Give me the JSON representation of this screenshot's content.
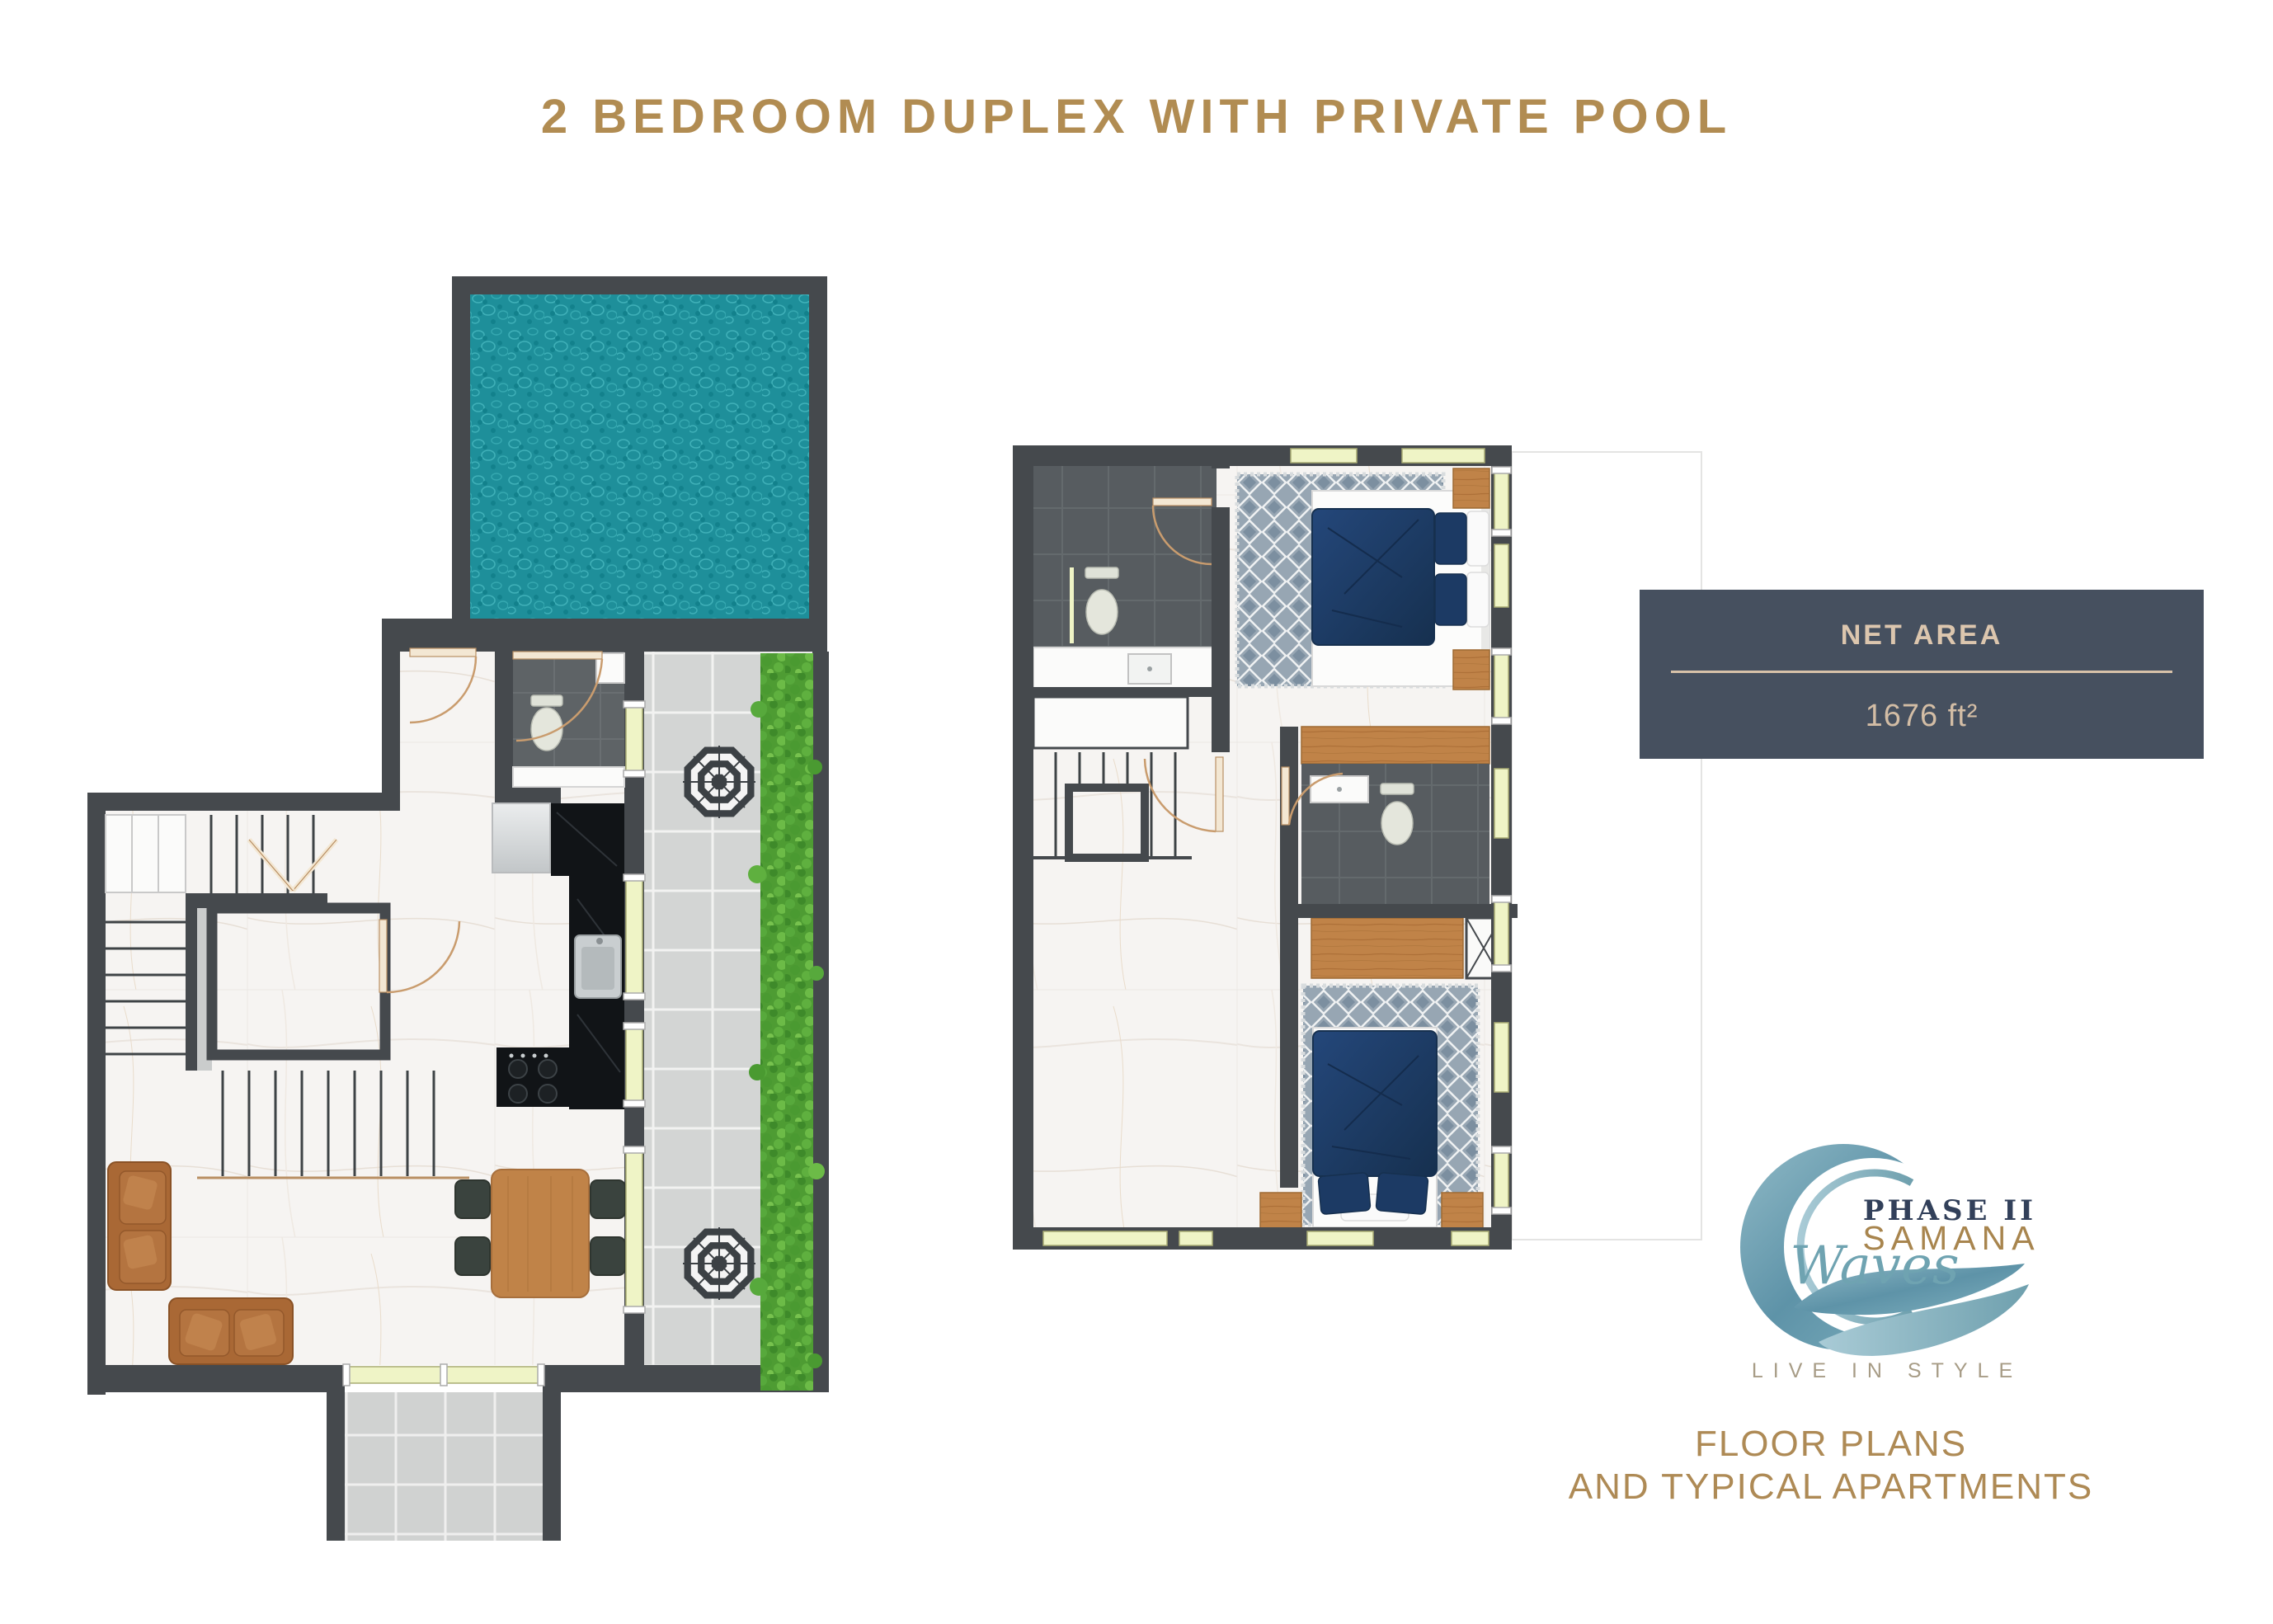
{
  "page": {
    "title": "2 BEDROOM DUPLEX WITH PRIVATE POOL"
  },
  "net_area": {
    "label": "NET AREA",
    "value": "1676 ft²"
  },
  "logo": {
    "phase_label": "PHASE II",
    "brand": "SAMANA",
    "script": "Waves",
    "tagline": "LIVE IN STYLE"
  },
  "footer": {
    "line1": "FLOOR PLANS",
    "line2": "AND TYPICAL APARTMENTS"
  },
  "colors": {
    "accent_gold": "#AE8A55",
    "panel_background": "#46505F",
    "panel_text": "#DCC6AE",
    "wall": "#45494D",
    "pool_water": "#1E8F9A",
    "terrace_tile": "#D3D5D4",
    "hedge_green": "#4E9C33",
    "marble_floor": "#F6F4F2",
    "bed_navy": "#1C3A64",
    "wood": "#C08348",
    "sofa_leather": "#AC6B39",
    "logo_navy": "#32405A",
    "logo_teal": "#6FA3B1"
  }
}
